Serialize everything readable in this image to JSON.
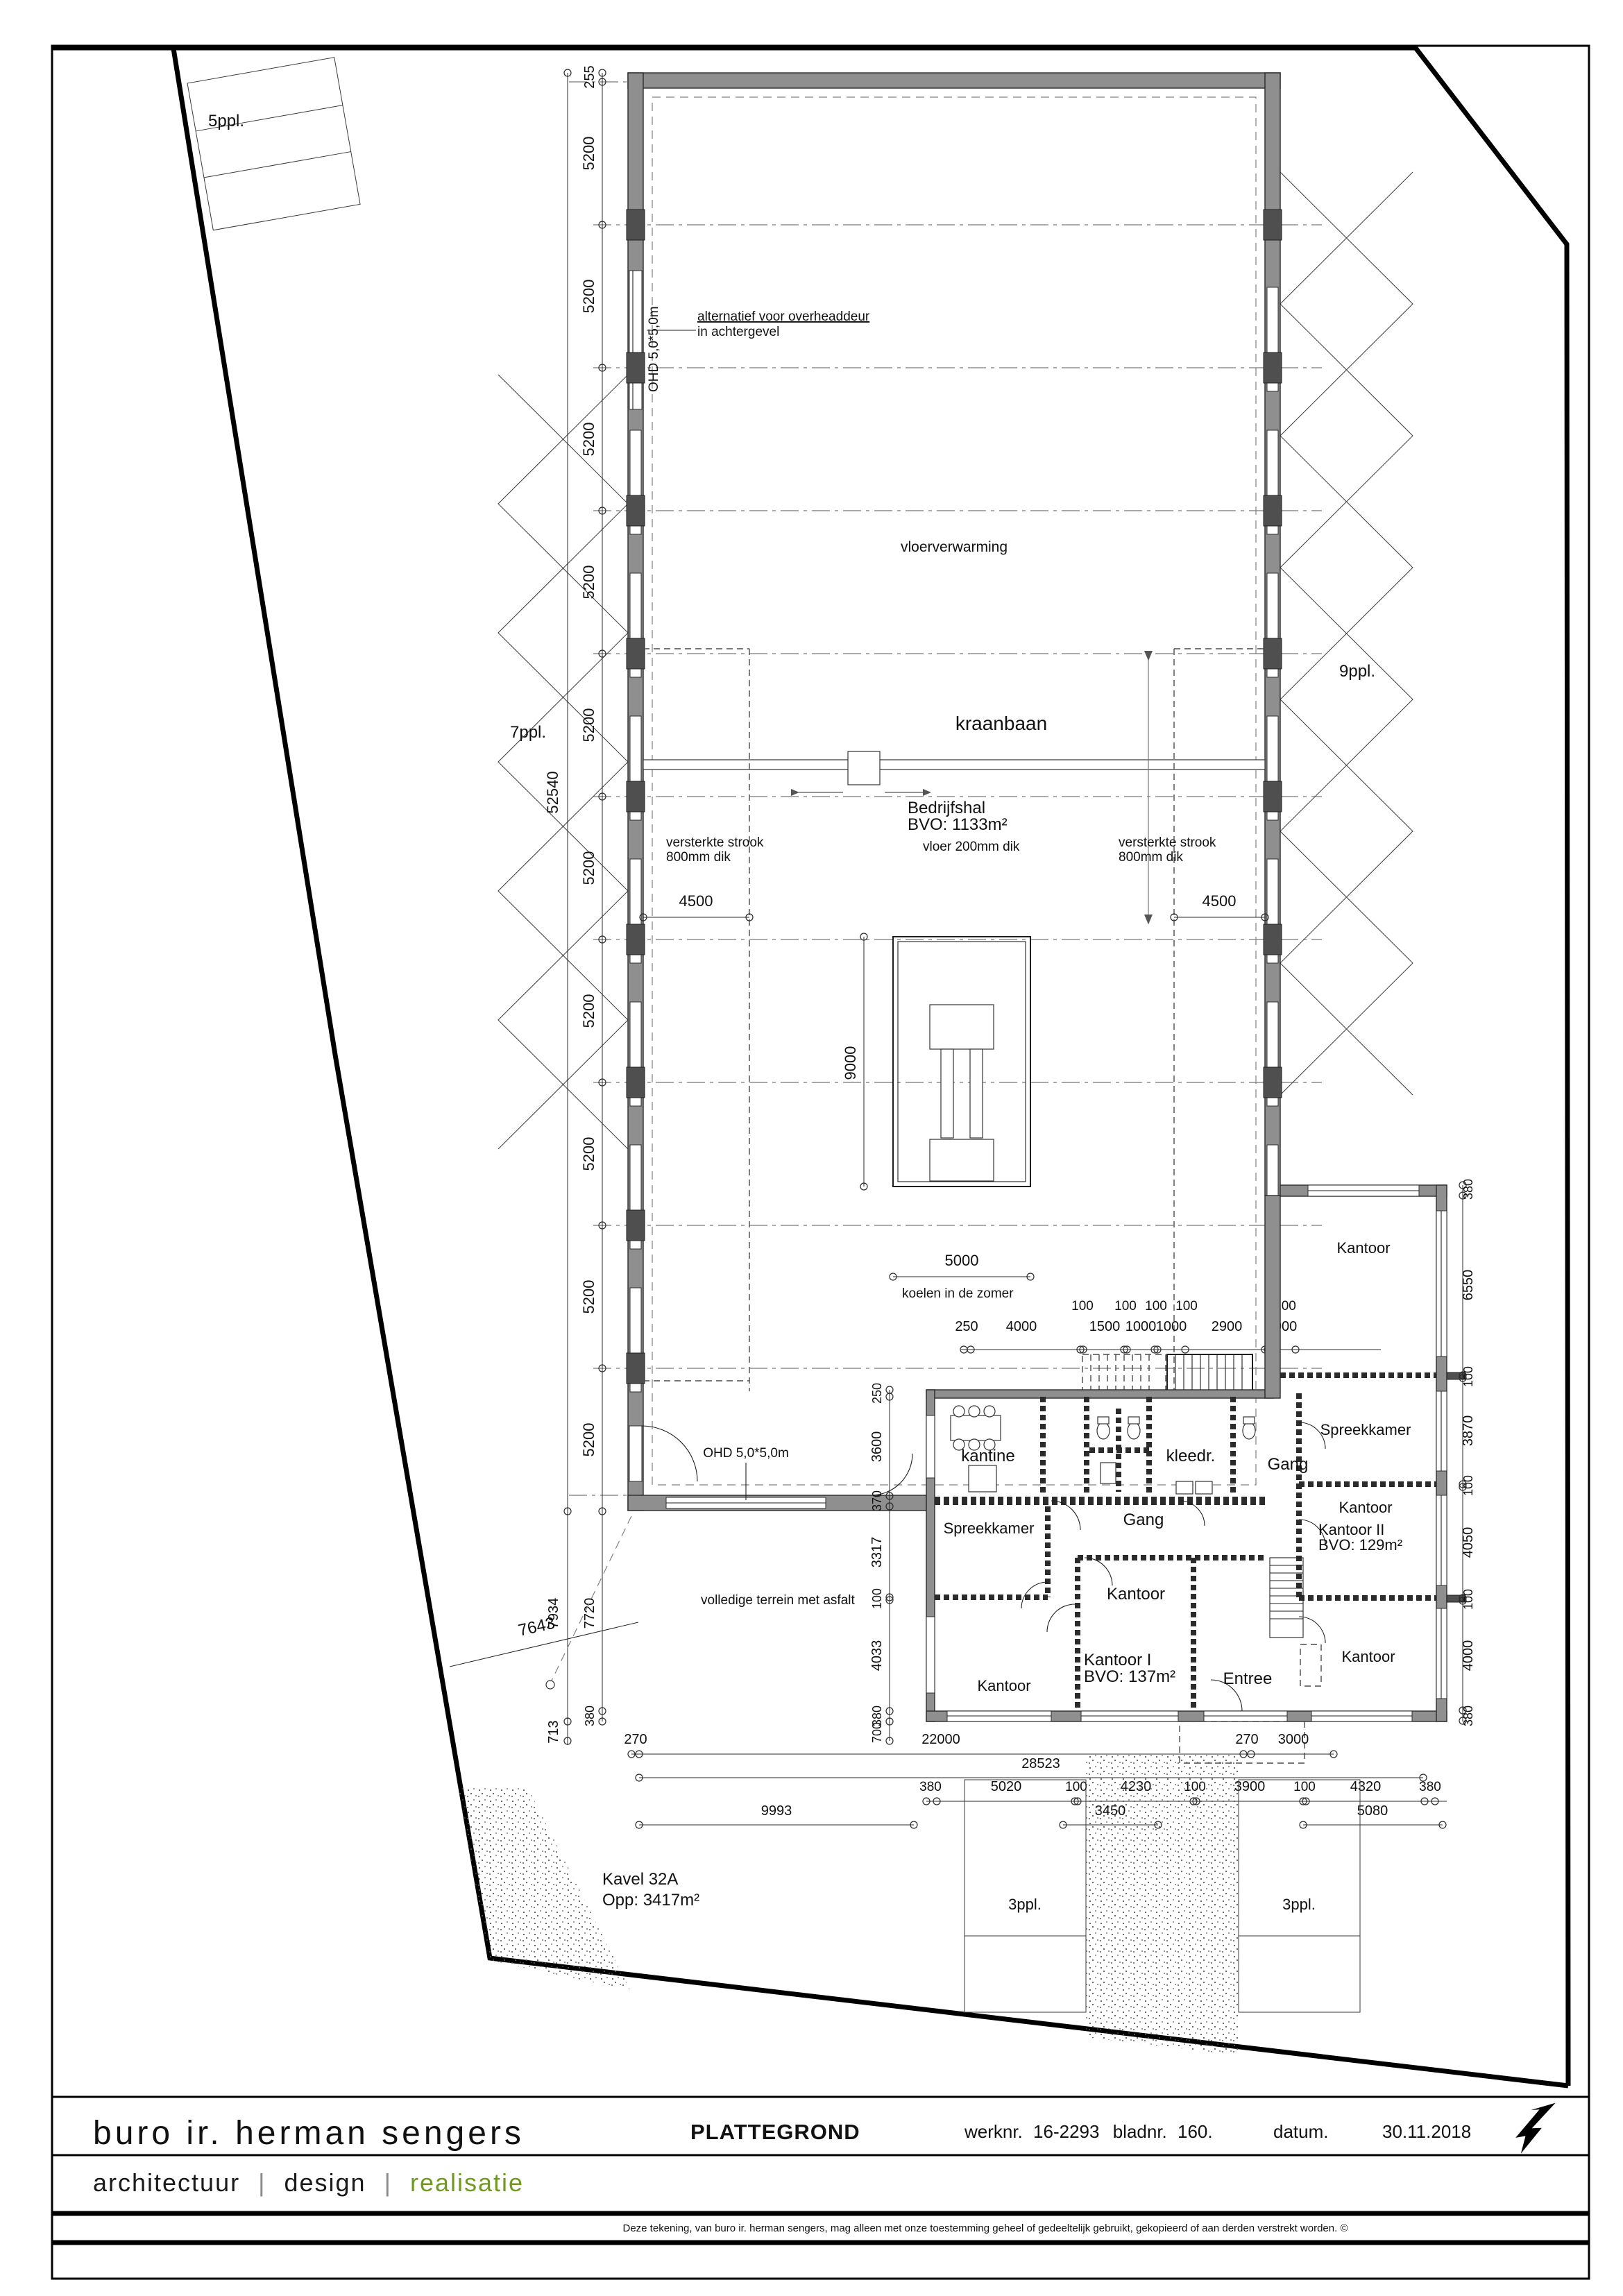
{
  "titleblock": {
    "firm": "buro ir. herman sengers",
    "doc_type": "PLATTEGROND",
    "werk_label": "werknr.",
    "werk_value": "16-2293",
    "blad_label": "bladnr.",
    "blad_value": "160.",
    "datum_label": "datum.",
    "datum_value": "30.11.2018",
    "tagline_a": "architectuur",
    "tagline_sep1": "|",
    "tagline_b": "design",
    "tagline_sep2": "|",
    "tagline_c": "realisatie",
    "disclaimer": "Deze tekening, van buro ir. herman sengers, mag alleen met onze toestemming geheel of gedeeltelijk gebruikt, gekopieerd of aan derden verstrekt worden. ©"
  },
  "colors": {
    "wall_gray": "#8f8f8f",
    "column_gray": "#4f4f4f",
    "line_black": "#1a1a1a",
    "accent_green": "#6f9a1f"
  },
  "site": {
    "kavel_line1": "Kavel 32A",
    "kavel_line2": "Opp: 3417m²",
    "terrain": "volledige terrein met asfalt",
    "parking_p5": "5ppl.",
    "parking_p7": "7ppl.",
    "parking_p9": "9ppl.",
    "parking_p3a": "3ppl.",
    "parking_p3b": "3ppl."
  },
  "hall": {
    "name_line1": "Bedrijfshal",
    "name_line2": "BVO: 1133m²",
    "heating": "vloerverwarming",
    "crane": "kraanbaan",
    "floor": "vloer 200mm dik",
    "strip_line1": "versterkte strook",
    "strip_line2": "800mm dik",
    "cooling": "koelen in de zomer",
    "ohd_alt_line1": "alternatief voor overheaddeur",
    "ohd_alt_line2": "in achtergevel",
    "ohd_west": "OHD 5,0*5,0m",
    "ohd_south": "OHD 5,0*5,0m"
  },
  "rooms": {
    "kantine": "kantine",
    "kleed": "kleedr.",
    "gang": "Gang",
    "spreekkamer": "Spreekkamer",
    "kantoor": "Kantoor",
    "kantoor1_line1": "Kantoor I",
    "kantoor1_line2": "BVO: 137m²",
    "kantoor2_line1": "Kantoor II",
    "kantoor2_line2": "BVO: 129m²",
    "entree": "Entree"
  },
  "dims": {
    "d255": "255",
    "d5200": "5200",
    "d52540": "52540",
    "d4500": "4500",
    "d9000": "9000",
    "d5000": "5000",
    "d250": "250",
    "d4000": "4000",
    "d100": "100",
    "d1500": "1500",
    "d1000": "1000",
    "d2900": "2900",
    "d3600": "3600",
    "d370": "370",
    "d3317": "3317",
    "d4033": "4033",
    "d380": "380",
    "d700": "700",
    "d713": "713",
    "d7720": "7720",
    "d7934": "7934",
    "d7643": "7643",
    "d6550": "6550",
    "d3870": "3870",
    "d4050": "4050",
    "d4000r": "4000",
    "d270": "270",
    "d22000": "22000",
    "d3000": "3000",
    "d28523": "28523",
    "d5020": "5020",
    "d4230": "4230",
    "d3900": "3900",
    "d4320": "4320",
    "d9993": "9993",
    "d3450": "3450",
    "d5080": "5080"
  }
}
